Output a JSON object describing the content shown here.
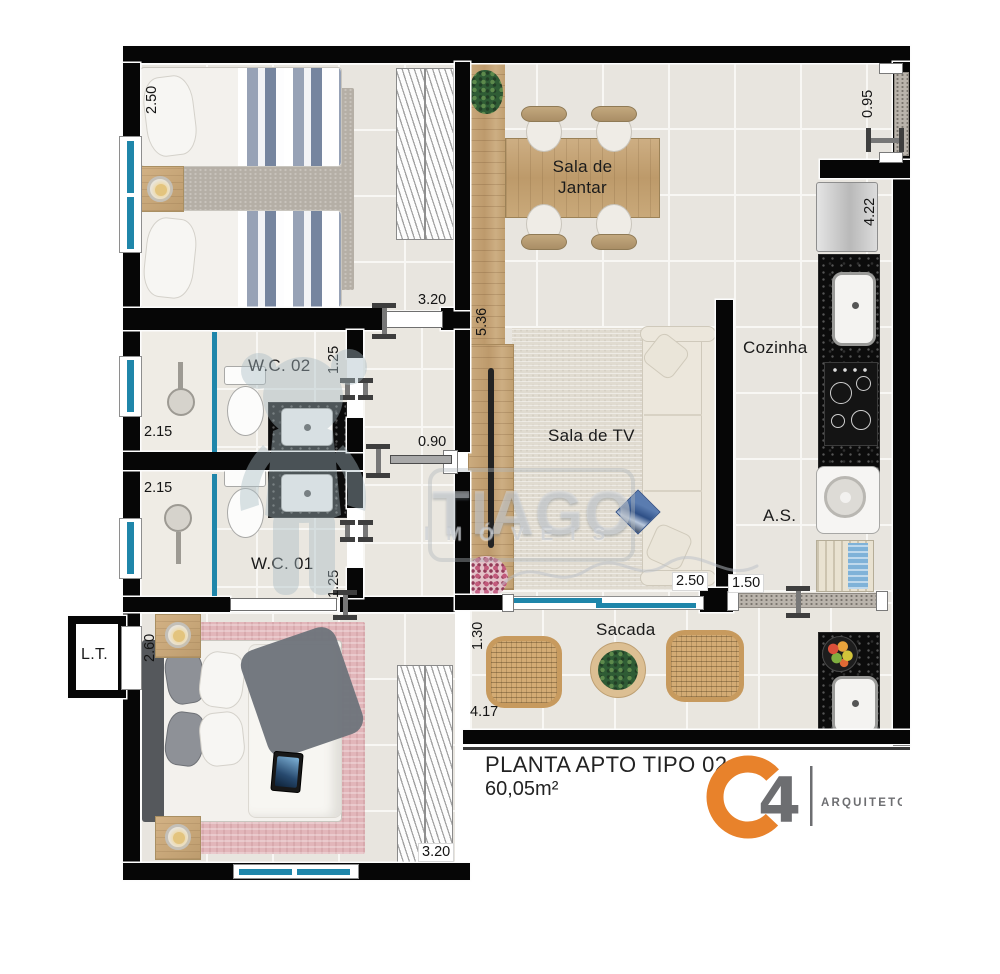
{
  "plan": {
    "title": "PLANTA APTO TIPO 02",
    "area": "60,05m²",
    "rooms": {
      "dining_l1": "Sala de",
      "dining_l2": "Jantar",
      "kitchen": "Cozinha",
      "tv": "Sala de TV",
      "service": "A.S.",
      "wc2": "W.C. 02",
      "wc1": "W.C. 01",
      "balcony": "Sacada",
      "lt": "L.T."
    },
    "dimensions": {
      "bed1_depth": "2.50",
      "bed1_width": "3.20",
      "dining_length": "5.36",
      "entry_width": "0.95",
      "kitchen_length": "4.22",
      "wc2_width": "2.15",
      "wc2_depth": "1.25",
      "wc1_width": "2.15",
      "wc1_depth": "1.25",
      "hall_width": "0.90",
      "tv_door_width": "2.50",
      "service_door_width": "1.50",
      "bed2_depth": "2.60",
      "bed2_width": "3.20",
      "balcony_depth": "1.30",
      "balcony_width": "4.17"
    },
    "watermark": {
      "name": "TIAGO",
      "word": "IMÓVEIS"
    },
    "logo": {
      "number": "4",
      "caption": "ARQUITETOS",
      "orange": "#E8822B",
      "gray": "#6D6E71"
    }
  }
}
